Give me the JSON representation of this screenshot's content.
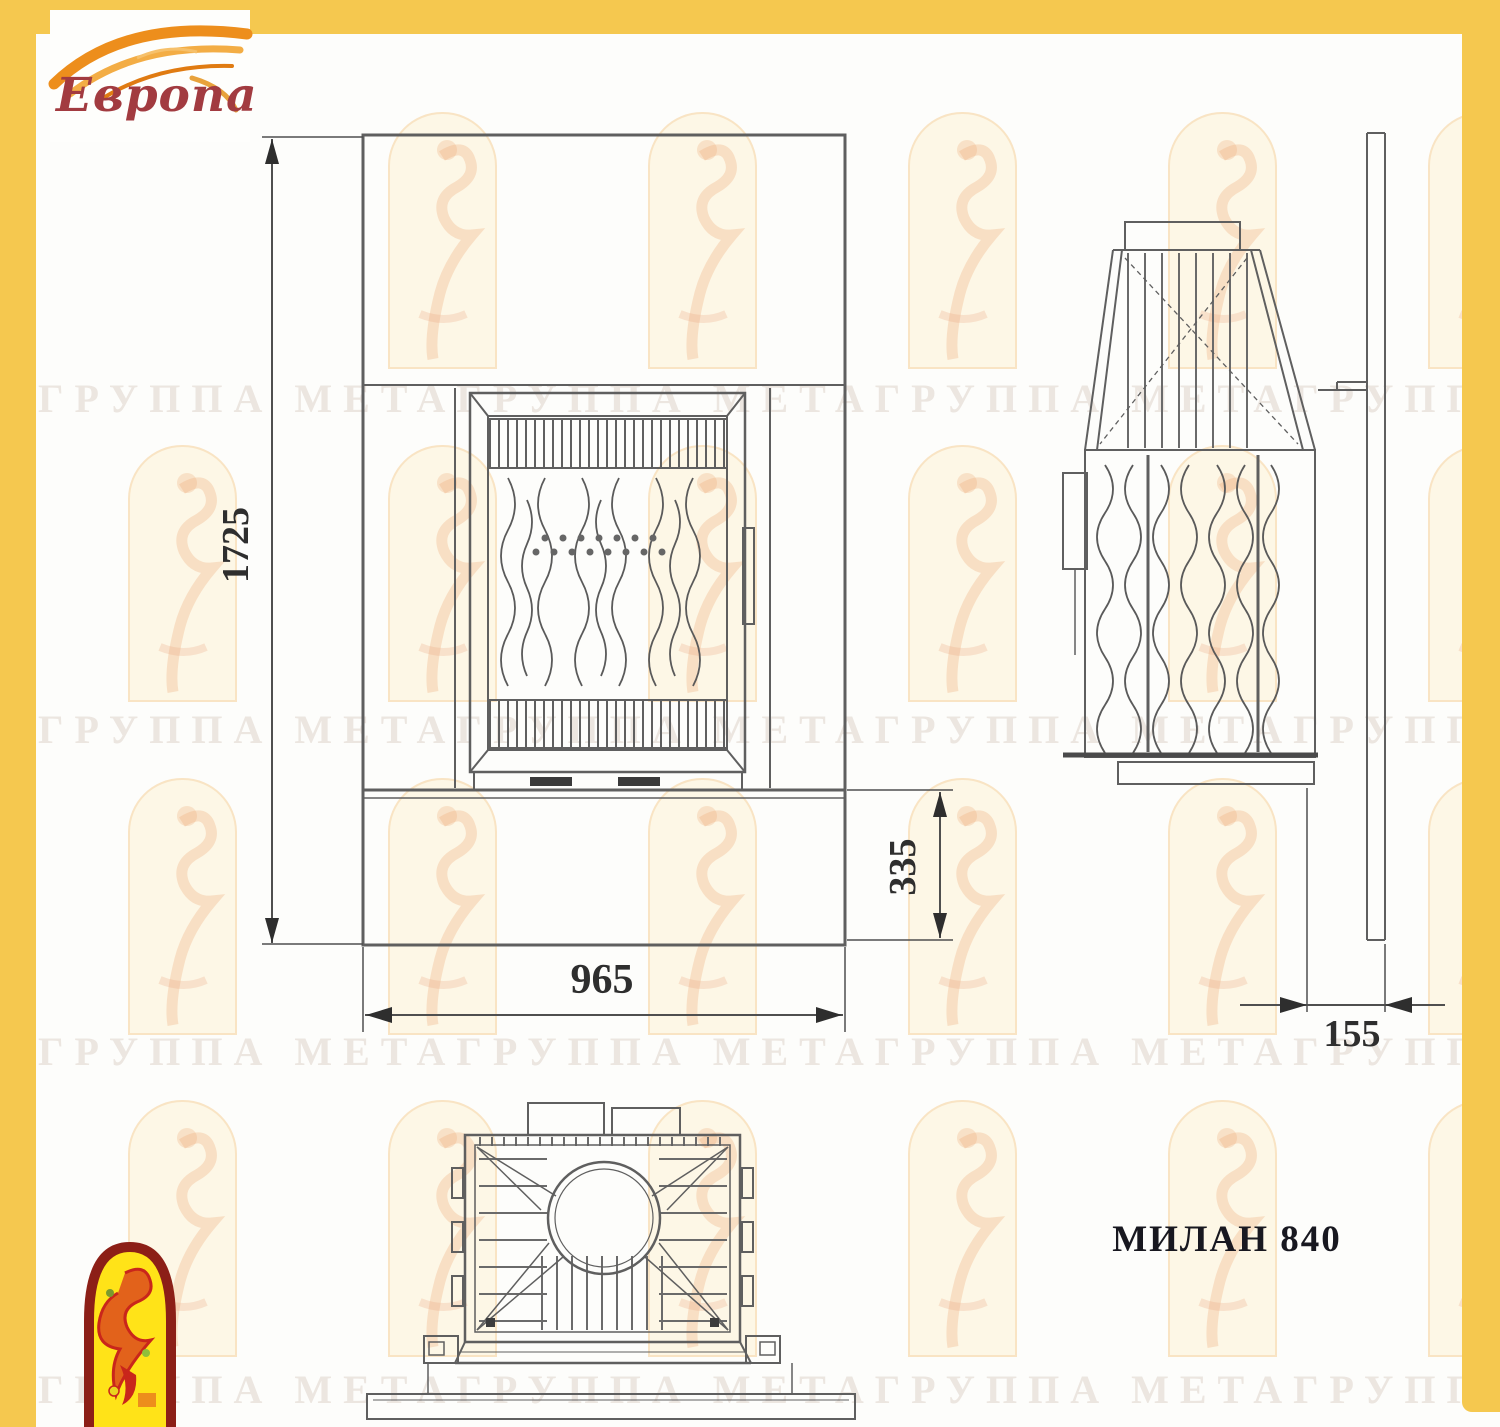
{
  "logo": {
    "brand": "Европа"
  },
  "model": {
    "label": "МИЛАН 840"
  },
  "dimensions": {
    "front_height_mm": "1725",
    "front_width_mm": "965",
    "base_height_mm": "335",
    "side_depth_mm": "155"
  },
  "watermark": {
    "row_text": "ГРУППА МЕТАГРУППА МЕТАГРУППА МЕТАГРУППА МЕТА"
  },
  "colors": {
    "frame_yellow": "#F5C84F",
    "drawing_line": "#5F5F5F",
    "dim_text": "#2E2E2E",
    "model_text": "#181820",
    "logo_red": "#A23B40",
    "flame_orange": "#ED8E1C",
    "icon_yellow": "#FFE318",
    "icon_border_red": "#8C1F17",
    "watermark_cream": "#FDF7E6"
  }
}
